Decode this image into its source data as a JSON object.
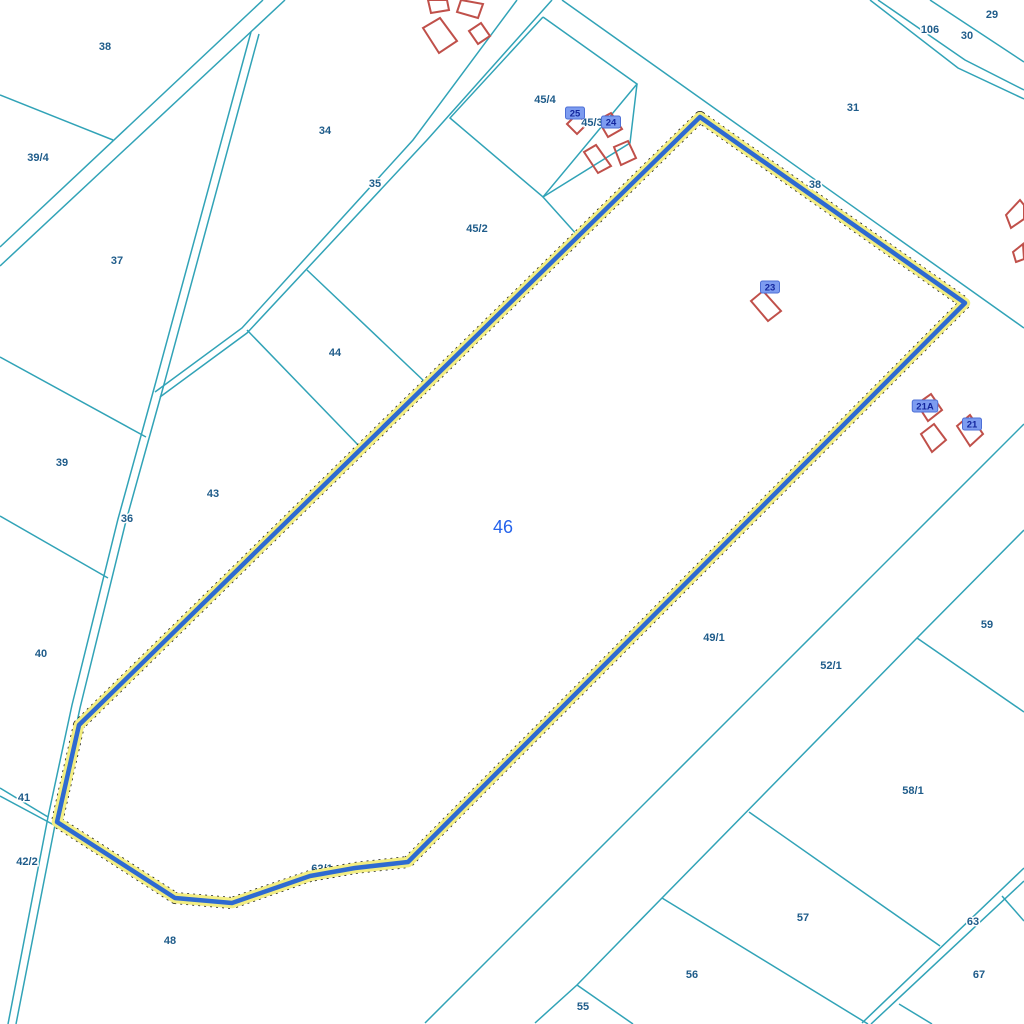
{
  "map": {
    "width": 1024,
    "height": 1024,
    "background": "#ffffff",
    "colors": {
      "boundary_teal": "#31a3b7",
      "building_red": "#c0504a",
      "label_blue": "#1f5c8a",
      "selected_parcel_blue": "#2e6ad1",
      "selected_halo_yellow": "#f3ee82",
      "selected_dash_black": "#1a1a1a",
      "selected_number_blue": "#2563eb",
      "badge_bg": "#7d9cf0",
      "badge_text": "#14279e"
    },
    "selected_parcel": {
      "number": "46",
      "label_x": 503,
      "label_y": 533,
      "vertices": [
        [
          700,
          117
        ],
        [
          965,
          303
        ],
        [
          408,
          862
        ],
        [
          355,
          868
        ],
        [
          310,
          876
        ],
        [
          232,
          903
        ],
        [
          175,
          898
        ],
        [
          57,
          822
        ],
        [
          79,
          725
        ]
      ]
    },
    "hidden_label": {
      "text": "62/1",
      "x": 322,
      "y": 872
    },
    "parcel_labels": [
      {
        "text": "38",
        "x": 105,
        "y": 50
      },
      {
        "text": "39/4",
        "x": 38,
        "y": 161
      },
      {
        "text": "34",
        "x": 325,
        "y": 134
      },
      {
        "text": "35",
        "x": 375,
        "y": 187
      },
      {
        "text": "37",
        "x": 117,
        "y": 264
      },
      {
        "text": "45/4",
        "x": 545,
        "y": 103
      },
      {
        "text": "45/3",
        "x": 592,
        "y": 126
      },
      {
        "text": "45/2",
        "x": 477,
        "y": 232
      },
      {
        "text": "44",
        "x": 335,
        "y": 356
      },
      {
        "text": "43",
        "x": 213,
        "y": 497
      },
      {
        "text": "39",
        "x": 62,
        "y": 466
      },
      {
        "text": "36",
        "x": 127,
        "y": 522
      },
      {
        "text": "40",
        "x": 41,
        "y": 657
      },
      {
        "text": "41",
        "x": 24,
        "y": 801
      },
      {
        "text": "42/2",
        "x": 27,
        "y": 865
      },
      {
        "text": "48",
        "x": 170,
        "y": 944
      },
      {
        "text": "31",
        "x": 853,
        "y": 111
      },
      {
        "text": "38",
        "x": 815,
        "y": 188
      },
      {
        "text": "106",
        "x": 930,
        "y": 33
      },
      {
        "text": "30",
        "x": 967,
        "y": 39
      },
      {
        "text": "29",
        "x": 992,
        "y": 18
      },
      {
        "text": "49/1",
        "x": 714,
        "y": 641
      },
      {
        "text": "52/1",
        "x": 831,
        "y": 669
      },
      {
        "text": "59",
        "x": 987,
        "y": 628
      },
      {
        "text": "58/1",
        "x": 913,
        "y": 794
      },
      {
        "text": "57",
        "x": 803,
        "y": 921
      },
      {
        "text": "63",
        "x": 973,
        "y": 925
      },
      {
        "text": "67",
        "x": 979,
        "y": 978
      },
      {
        "text": "56",
        "x": 692,
        "y": 978
      },
      {
        "text": "55",
        "x": 583,
        "y": 1010
      }
    ],
    "building_badges": [
      {
        "text": "25",
        "x": 575,
        "y": 113
      },
      {
        "text": "24",
        "x": 611,
        "y": 122
      },
      {
        "text": "23",
        "x": 770,
        "y": 287
      },
      {
        "text": "21A",
        "x": 925,
        "y": 406
      },
      {
        "text": "21",
        "x": 972,
        "y": 424
      }
    ],
    "boundary_lines": [
      {
        "pts": [
          [
            263,
            0
          ],
          [
            0,
            247
          ]
        ]
      },
      {
        "pts": [
          [
            285,
            0
          ],
          [
            0,
            266
          ]
        ]
      },
      {
        "pts": [
          [
            251,
            32
          ],
          [
            155,
            385
          ],
          [
            118,
            519
          ],
          [
            72,
            705
          ],
          [
            48,
            817
          ],
          [
            8,
            1024
          ]
        ]
      },
      {
        "pts": [
          [
            259,
            34
          ],
          [
            163,
            388
          ],
          [
            126,
            521
          ],
          [
            80,
            708
          ],
          [
            55,
            825
          ],
          [
            16,
            1024
          ]
        ]
      },
      {
        "pts": [
          [
            517,
            0
          ],
          [
            413,
            140
          ],
          [
            242,
            328
          ],
          [
            155,
            392
          ]
        ]
      },
      {
        "pts": [
          [
            552,
            0
          ],
          [
            427,
            140
          ],
          [
            247,
            333
          ],
          [
            160,
            397
          ]
        ]
      },
      {
        "pts": [
          [
            878,
            0
          ],
          [
            965,
            60
          ],
          [
            1024,
            90
          ]
        ]
      },
      {
        "pts": [
          [
            870,
            0
          ],
          [
            958,
            68
          ],
          [
            1024,
            99
          ]
        ]
      },
      {
        "pts": [
          [
            930,
            0
          ],
          [
            1024,
            62
          ]
        ]
      },
      {
        "pts": [
          [
            562,
            0
          ],
          [
            1024,
            328
          ]
        ]
      },
      {
        "pts": [
          [
            0,
            95
          ],
          [
            113,
            140
          ]
        ]
      },
      {
        "pts": [
          [
            0,
            357
          ],
          [
            146,
            437
          ]
        ]
      },
      {
        "pts": [
          [
            0,
            516
          ],
          [
            108,
            578
          ]
        ]
      },
      {
        "pts": [
          [
            0,
            788
          ],
          [
            48,
            817
          ]
        ]
      },
      {
        "pts": [
          [
            0,
            796
          ],
          [
            54,
            825
          ]
        ]
      },
      {
        "pts": [
          [
            307,
            270
          ],
          [
            425,
            382
          ]
        ]
      },
      {
        "pts": [
          [
            247,
            330
          ],
          [
            361,
            448
          ]
        ]
      },
      {
        "pts": [
          [
            543,
            17
          ],
          [
            637,
            84
          ],
          [
            543,
            197
          ],
          [
            450,
            118
          ],
          [
            543,
            17
          ]
        ]
      },
      {
        "pts": [
          [
            637,
            84
          ],
          [
            630,
            143
          ],
          [
            543,
            197
          ]
        ]
      },
      {
        "pts": [
          [
            543,
            197
          ],
          [
            578,
            236
          ]
        ]
      },
      {
        "pts": [
          [
            1024,
            424
          ],
          [
            425,
            1023
          ]
        ]
      },
      {
        "pts": [
          [
            1024,
            530
          ],
          [
            917,
            638
          ],
          [
            662,
            898
          ],
          [
            577,
            985
          ],
          [
            535,
            1023
          ]
        ]
      },
      {
        "pts": [
          [
            917,
            638
          ],
          [
            1024,
            712
          ]
        ]
      },
      {
        "pts": [
          [
            749,
            812
          ],
          [
            940,
            946
          ]
        ]
      },
      {
        "pts": [
          [
            662,
            898
          ],
          [
            868,
            1024
          ]
        ]
      },
      {
        "pts": [
          [
            577,
            985
          ],
          [
            633,
            1024
          ]
        ]
      },
      {
        "pts": [
          [
            1024,
            868
          ],
          [
            862,
            1023
          ]
        ]
      },
      {
        "pts": [
          [
            1024,
            881
          ],
          [
            871,
            1024
          ]
        ]
      },
      {
        "pts": [
          [
            1002,
            896
          ],
          [
            1024,
            921
          ]
        ]
      },
      {
        "pts": [
          [
            899,
            1004
          ],
          [
            932,
            1024
          ]
        ]
      }
    ],
    "buildings": [
      {
        "pts": [
          [
            428,
            0
          ],
          [
            447,
            0
          ],
          [
            449,
            10
          ],
          [
            431,
            13
          ]
        ]
      },
      {
        "pts": [
          [
            423,
            28
          ],
          [
            440,
            18
          ],
          [
            457,
            41
          ],
          [
            439,
            53
          ]
        ]
      },
      {
        "pts": [
          [
            461,
            0
          ],
          [
            483,
            4
          ],
          [
            478,
            18
          ],
          [
            457,
            12
          ]
        ]
      },
      {
        "pts": [
          [
            469,
            31
          ],
          [
            481,
            23
          ],
          [
            490,
            36
          ],
          [
            478,
            44
          ]
        ]
      },
      {
        "pts": [
          [
            567,
            124
          ],
          [
            577,
            114
          ],
          [
            587,
            124
          ],
          [
            577,
            134
          ]
        ]
      },
      {
        "pts": [
          [
            598,
            120
          ],
          [
            611,
            113
          ],
          [
            622,
            129
          ],
          [
            608,
            137
          ]
        ]
      },
      {
        "pts": [
          [
            584,
            152
          ],
          [
            596,
            145
          ],
          [
            611,
            166
          ],
          [
            598,
            173
          ]
        ]
      },
      {
        "pts": [
          [
            614,
            147
          ],
          [
            628,
            141
          ],
          [
            636,
            158
          ],
          [
            621,
            165
          ]
        ]
      },
      {
        "pts": [
          [
            751,
            301
          ],
          [
            763,
            291
          ],
          [
            781,
            311
          ],
          [
            768,
            321
          ]
        ]
      },
      {
        "pts": [
          [
            917,
            404
          ],
          [
            931,
            394
          ],
          [
            942,
            410
          ],
          [
            928,
            421
          ]
        ]
      },
      {
        "pts": [
          [
            921,
            434
          ],
          [
            934,
            424
          ],
          [
            946,
            440
          ],
          [
            932,
            452
          ]
        ]
      },
      {
        "pts": [
          [
            957,
            426
          ],
          [
            970,
            415
          ],
          [
            983,
            434
          ],
          [
            970,
            446
          ]
        ]
      },
      {
        "pts": [
          [
            1006,
            215
          ],
          [
            1020,
            200
          ],
          [
            1024,
            205
          ],
          [
            1024,
            219
          ],
          [
            1011,
            228
          ]
        ]
      },
      {
        "pts": [
          [
            1013,
            252
          ],
          [
            1023,
            244
          ],
          [
            1024,
            259
          ],
          [
            1016,
            262
          ]
        ]
      }
    ]
  }
}
